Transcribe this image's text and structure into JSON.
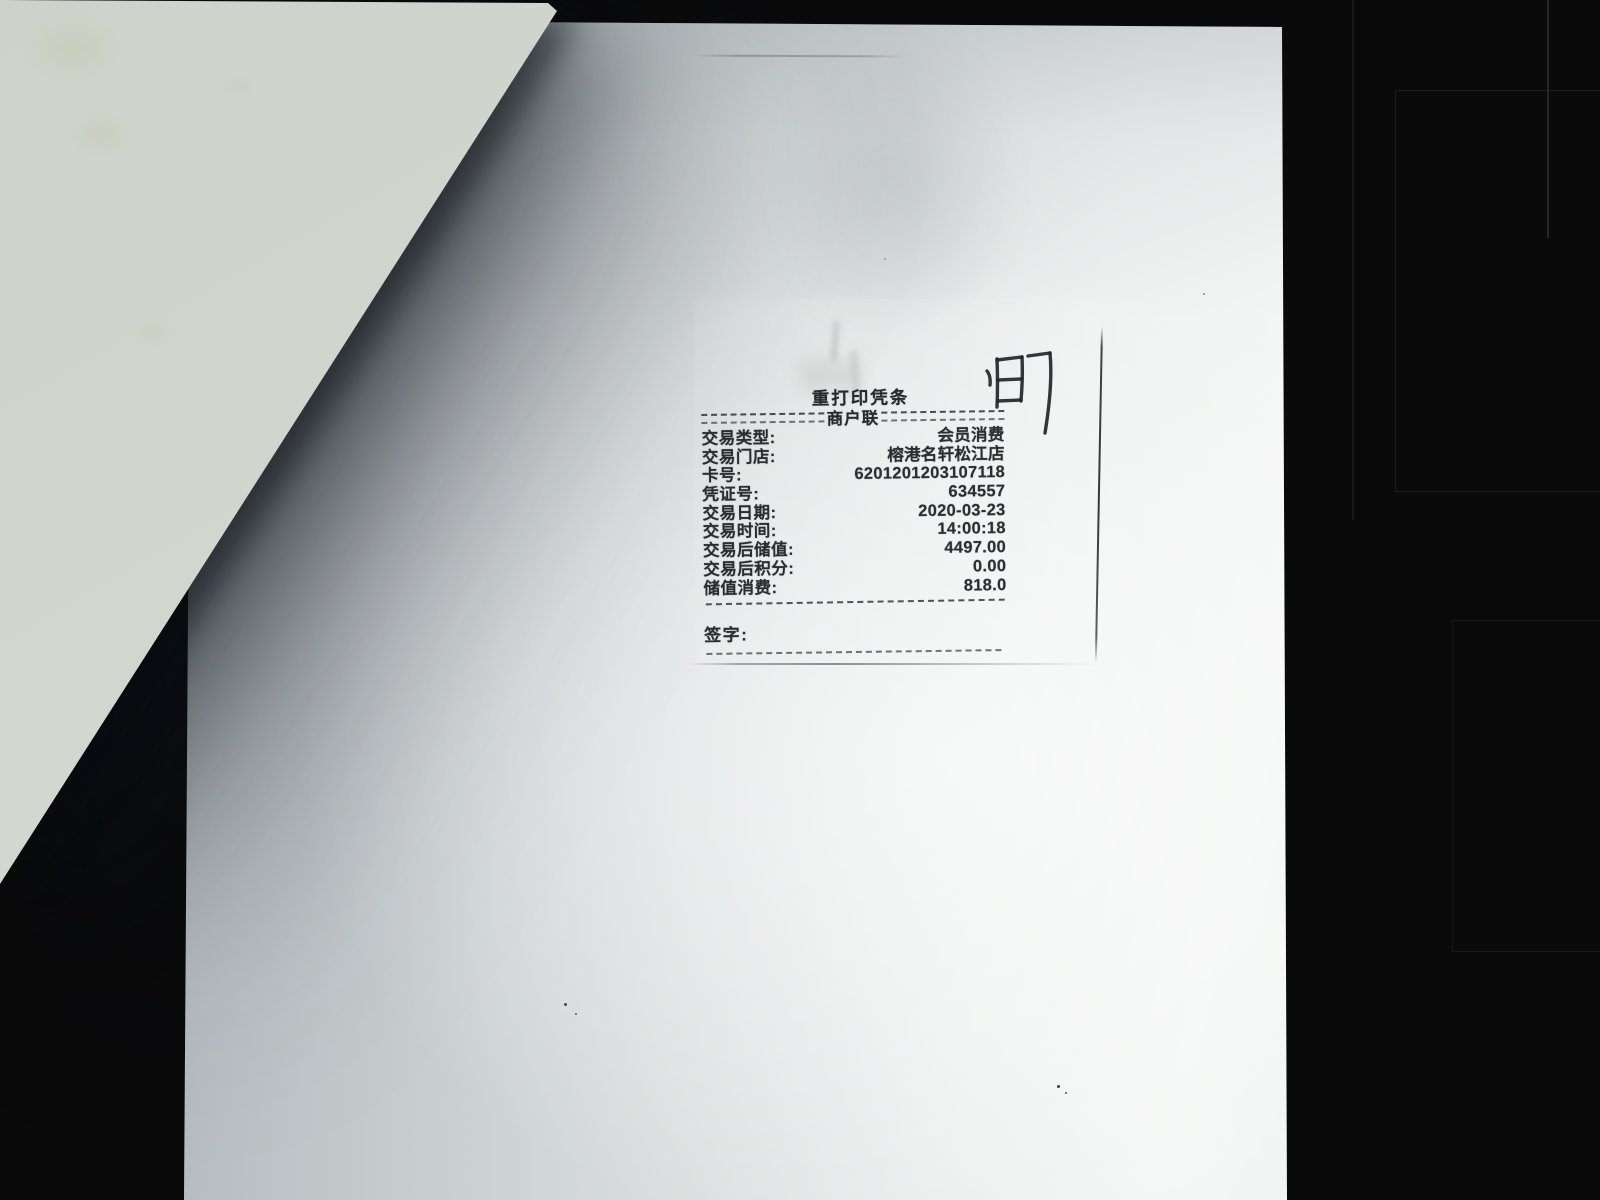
{
  "document": {
    "kind": "photographed-receipt-photocopy",
    "receipt": {
      "title": "重打印凭条",
      "copy_label": "商户联",
      "rows": [
        {
          "label": "交易类型:",
          "value": "会员消费"
        },
        {
          "label": "交易门店:",
          "value": "榕港名轩松江店"
        },
        {
          "label": "卡号:",
          "value": "6201201203107118"
        },
        {
          "label": "凭证号:",
          "value": "634557"
        },
        {
          "label": "交易日期:",
          "value": "2020-03-23"
        },
        {
          "label": "交易时间:",
          "value": "14:00:18"
        },
        {
          "label": "交易后储值:",
          "value": "4497.00"
        },
        {
          "label": "交易后积分:",
          "value": "0.00"
        },
        {
          "label": "储值消费:",
          "value": "818.0"
        }
      ],
      "signature_label": "签字:"
    },
    "handwriting": {
      "gloss": "町7",
      "strokes": {
        "s1": "M14,27 Q18,32 17,41",
        "s2": "M24,15 Q25,40 24,63",
        "s3": "M24,16 L49,13",
        "s4": "M49,13 Q50,33 48,57",
        "s5": "M25,36 L48,35",
        "s6": "M25,57 L48,56",
        "s7": "M55,12 L77,9",
        "s8": "M77,9 Q80,40 72,89"
      }
    },
    "colors": {
      "background": "#0a0a0b",
      "paper_bright": "#f5f7f6",
      "paper_shadow": "#9fa7ad",
      "overlay_sheet": "#d2d8d0",
      "print_ink": "#2b2e31",
      "pen_ink": "#24252b"
    }
  }
}
